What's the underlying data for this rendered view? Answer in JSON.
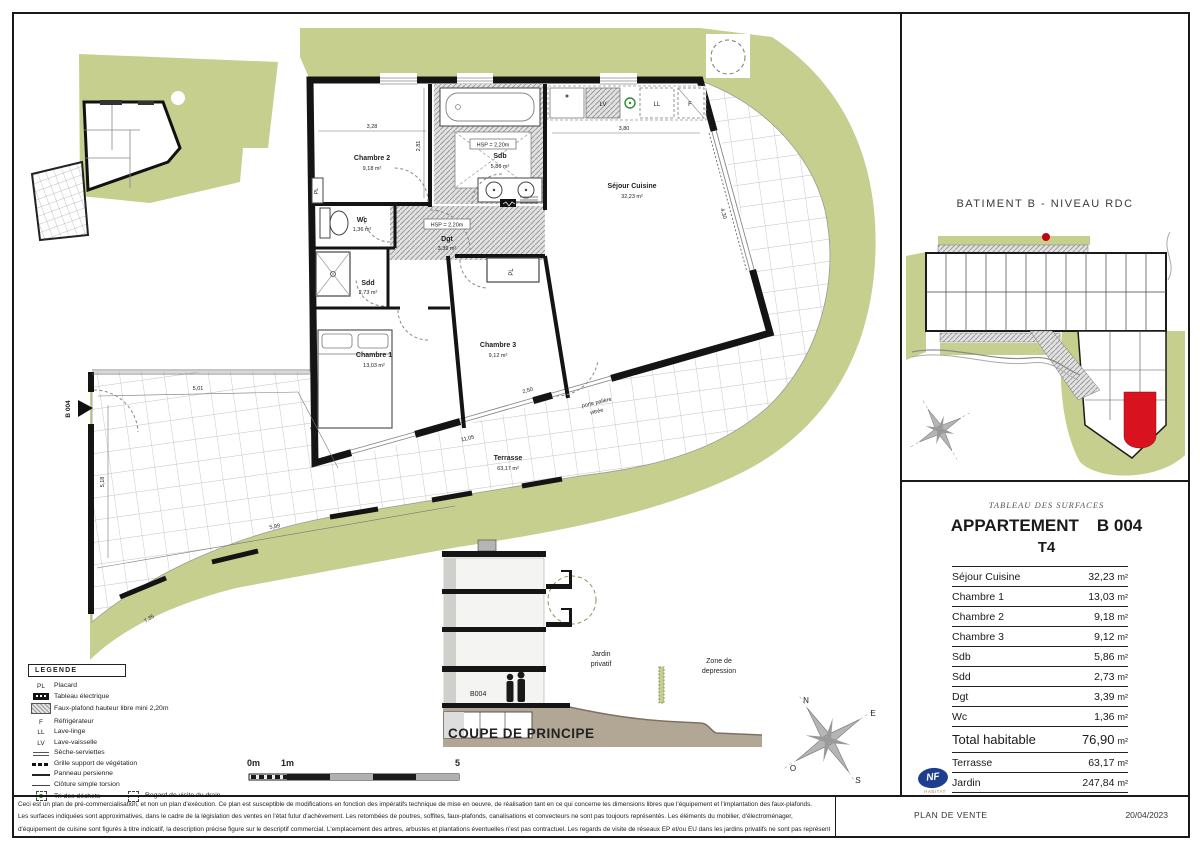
{
  "floor_plan": {
    "rooms": [
      {
        "name": "Chambre 2",
        "area": "9,18 m²"
      },
      {
        "name": "Sdb",
        "area": "5,86 m²"
      },
      {
        "name": "Wc",
        "area": "1,36 m²"
      },
      {
        "name": "Dgt",
        "area": "3,39 m²"
      },
      {
        "name": "Sdd",
        "area": "2,73 m²"
      },
      {
        "name": "Chambre 1",
        "area": "13,03 m²"
      },
      {
        "name": "Chambre 3",
        "area": "9,12 m²"
      },
      {
        "name": "Séjour Cuisine",
        "area": "32,23 m²"
      },
      {
        "name": "Terrasse",
        "area": "63,17 m²"
      }
    ],
    "hsp_note": "HSP = 2,20m",
    "entrance_label": "B 004",
    "entry_door_line1": "porte palière",
    "entry_door_line2": "vitrée",
    "appliances": {
      "lv": "LV",
      "ll": "LL",
      "f": "F"
    },
    "placard": "PL",
    "dimensions": {
      "d1": "3,28",
      "d2": "2,81",
      "d3": "3,80",
      "d4": "4,30",
      "d5": "2,50",
      "d6": "5,01",
      "d7": "3,08",
      "d8": "5,18",
      "d9": "5,99",
      "d10": "7,35",
      "d11": "11,05"
    }
  },
  "site_plan": {
    "title": "BATIMENT B  -  NIVEAU RDC"
  },
  "surfaces": {
    "header": "TABLEAU DES SURFACES",
    "title_left": "APPARTEMENT",
    "title_right": "B 004",
    "subtitle": "T4",
    "rows": [
      {
        "label": "Séjour Cuisine",
        "value": "32,23",
        "unit": "m²"
      },
      {
        "label": "Chambre 1",
        "value": "13,03",
        "unit": "m²"
      },
      {
        "label": "Chambre 2",
        "value": "9,18",
        "unit": "m²"
      },
      {
        "label": "Chambre 3",
        "value": "9,12",
        "unit": "m²"
      },
      {
        "label": "Sdb",
        "value": "5,86",
        "unit": "m²"
      },
      {
        "label": "Sdd",
        "value": "2,73",
        "unit": "m²"
      },
      {
        "label": "Dgt",
        "value": "3,39",
        "unit": "m²"
      },
      {
        "label": "Wc",
        "value": "1,36",
        "unit": "m²"
      }
    ],
    "total": {
      "label": "Total habitable",
      "value": "76,90",
      "unit": "m²"
    },
    "extra": [
      {
        "label": "Terrasse",
        "value": "63,17",
        "unit": "m²"
      },
      {
        "label": "Jardin",
        "value": "247,84",
        "unit": "m²"
      }
    ],
    "nf": {
      "text": "NF",
      "sub": "HABITAT"
    }
  },
  "section": {
    "title": "COUPE DE PRINCIPE",
    "unit": "B004",
    "garden_line1": "Jardin",
    "garden_line2": "privatif",
    "zone_line1": "Zone de",
    "zone_line2": "depression"
  },
  "scale": {
    "s0": "0m",
    "s1": "1m",
    "s5": "5"
  },
  "compass": {
    "n": "N",
    "e": "E",
    "s": "S",
    "o": "O"
  },
  "legend": {
    "header": "LEGENDE",
    "items": [
      {
        "sym": "PL",
        "label": "Placard"
      },
      {
        "sym": "",
        "label": "Tableau électrique"
      },
      {
        "sym": "",
        "label": "Faux-plafond hauteur libre mini 2,20m"
      },
      {
        "sym": "F",
        "label": "Réfrigérateur"
      },
      {
        "sym": "LL",
        "label": "Lave-linge"
      },
      {
        "sym": "LV",
        "label": "Lave-vaisselle"
      },
      {
        "sym": "",
        "label": "Sèche-serviettes"
      },
      {
        "sym": "",
        "label": "Grille support de végétation"
      },
      {
        "sym": "",
        "label": "Panneau persienne"
      },
      {
        "sym": "",
        "label": "Clôture simple torsion"
      },
      {
        "sym": "",
        "label": "Tri des déchets"
      },
      {
        "sym": "",
        "label": "Regard de visite du drain"
      }
    ]
  },
  "footer": {
    "line1": "Ceci est un plan de pré-commercialisation, et non un plan d'exécution. Ce plan est susceptible de modifications en fonction des impératifs technique de mise en oeuvre, de réalisation tant en ce qui concerne les dimensions libres que l'équipement et l'implantation des faux-plafonds.",
    "line2": "Les surfaces indiquées sont approximatives, dans le cadre de la législation des ventes en l'état futur d'achèvement. Les retombées de poutres, soffites, faux-plafonds, canalisations et convecteurs ne sont pas toujours représentés. Les éléments du mobilier, d'électroménager,",
    "line3": "d'équipement de cuisine sont figurés à titre indicatif, la description précise figure sur le descriptif commercial. L'emplacement des arbres, arbustes et plantations éventuelles n'est pas contractuel. Les regards de visite de réseaux EP et/ou EU dans les jardins privatifs ne sont pas représentés.",
    "doc_type": "PLAN DE VENTE",
    "date": "20/04/2023"
  },
  "colors": {
    "garden": "#c6cf8e",
    "highlight_red": "#d8121f",
    "nf_blue": "#1d3e8f",
    "ground": "#b2a794"
  }
}
